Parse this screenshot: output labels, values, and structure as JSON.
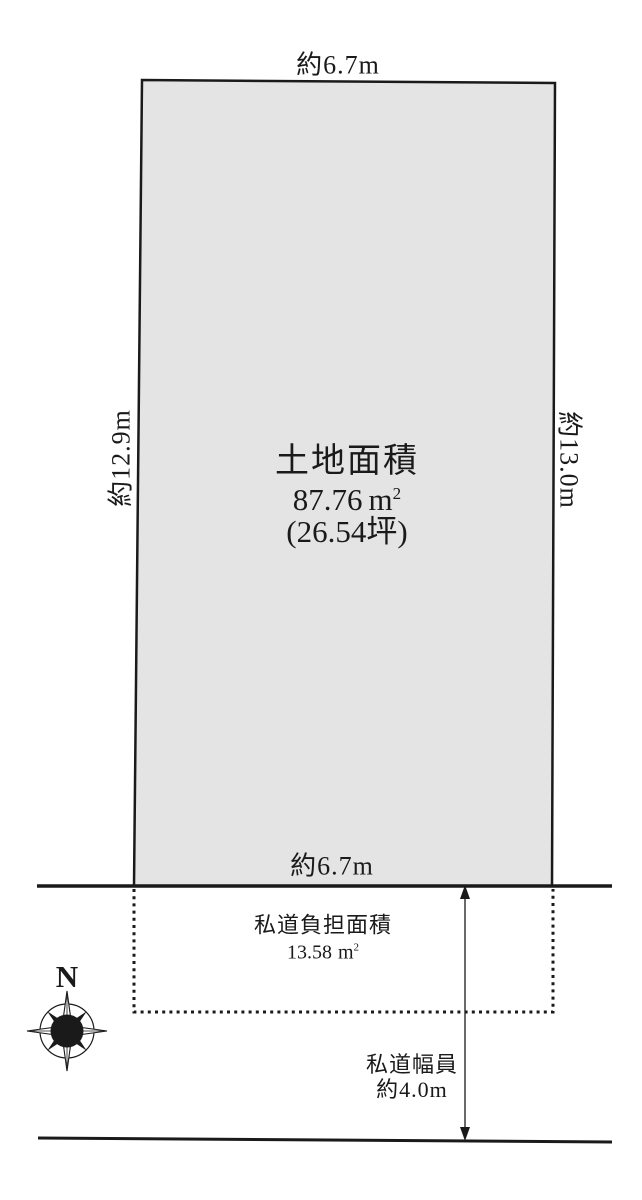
{
  "parcel": {
    "top_dim": "約6.7m",
    "left_dim": "約12.9m",
    "right_dim": "約13.0m",
    "bottom_dim": "約6.7m",
    "area_title": "土地面積",
    "area_value": "87.76",
    "area_unit": "m",
    "area_unit_sup": "2",
    "tsubo": "(26.54坪)"
  },
  "private_road": {
    "burden_label": "私道負担面積",
    "burden_value": "13.58",
    "burden_unit": "m",
    "burden_unit_sup": "2",
    "width_label": "私道幅員",
    "width_value": "約4.0m"
  },
  "compass": {
    "north_label": "N"
  },
  "colors": {
    "parcel_fill": "#e4e4e4",
    "line": "#1a1a1a",
    "background": "#ffffff"
  }
}
